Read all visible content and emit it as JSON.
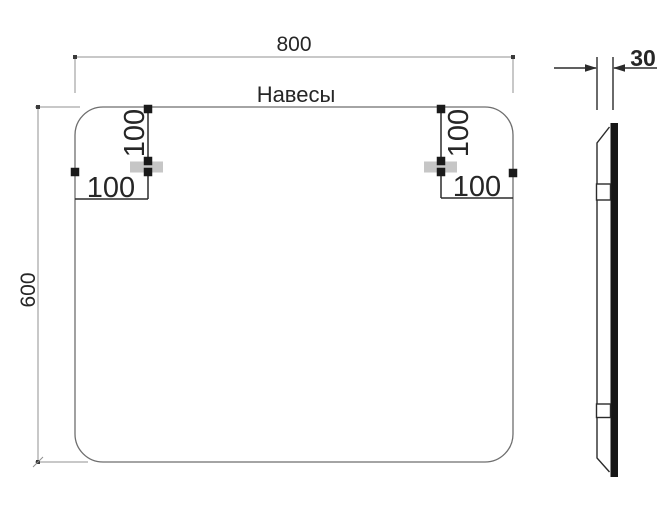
{
  "drawing": {
    "product_label": "Навесы",
    "front_view": {
      "width_label": "800",
      "height_label": "600",
      "left_hanger": {
        "vertical_offset_label": "100",
        "horizontal_offset_label": "100"
      },
      "right_hanger": {
        "vertical_offset_label": "100",
        "horizontal_offset_label": "100"
      }
    },
    "side_view": {
      "thickness_label": "30"
    },
    "colors": {
      "outline": "#6e6e6e",
      "dimension_line": "#909090",
      "detail_line": "#2b2b2b",
      "text": "#262626",
      "hanger_fill": "#c6c6c6",
      "glass_bar": "#161616"
    }
  }
}
